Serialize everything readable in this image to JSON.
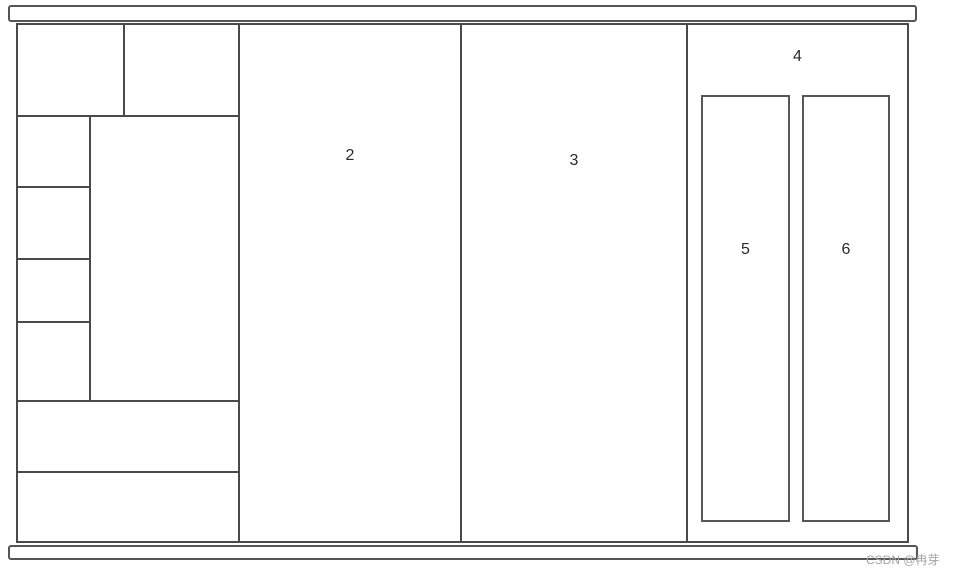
{
  "diagram_labels": {
    "region2": "2",
    "region3": "3",
    "region4": "4",
    "column5": "5",
    "column6": "6"
  },
  "watermark": {
    "text": "CSDN @冉芽"
  },
  "colors": {
    "line": "#4a4a4a",
    "rail_line": "#555555",
    "background": "#ffffff",
    "label_text": "#2a2a2a",
    "watermark_text": "#a3a3af"
  }
}
